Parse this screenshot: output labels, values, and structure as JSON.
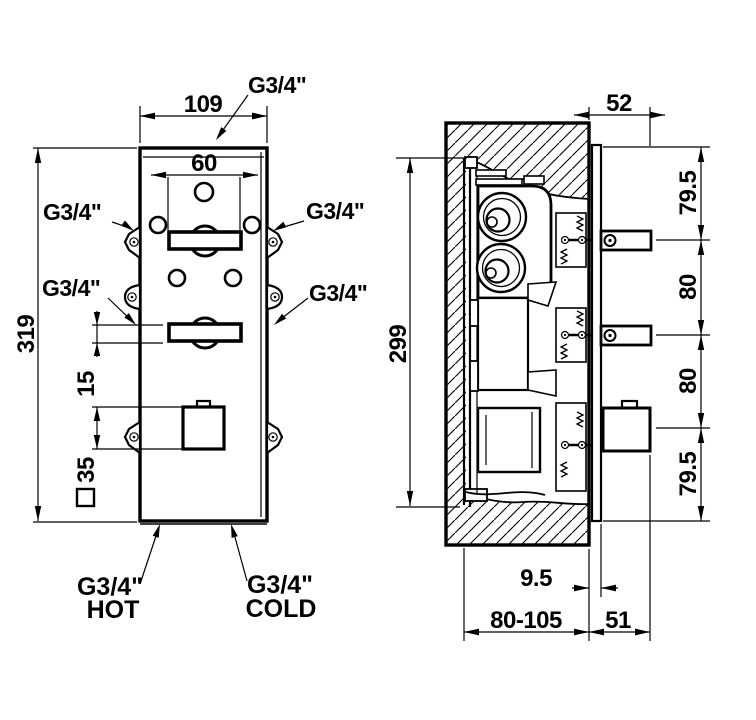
{
  "front": {
    "dims": {
      "width": "109",
      "handle_width": "60",
      "height": "319",
      "handle_to_knob": "15",
      "knob_square": "35"
    },
    "ports": {
      "top": "G3/4\"",
      "left_upper": "G3/4\"",
      "right_upper": "G3/4\"",
      "left_lower": "G3/4\"",
      "right_lower": "G3/4\"",
      "hot_size": "G3/4\"",
      "hot_word": "HOT",
      "cold_size": "G3/4\"",
      "cold_word": "COLD"
    }
  },
  "side": {
    "dims": {
      "depth": "52",
      "seg_top": "79.5",
      "seg_upper_mid": "80",
      "seg_lower_mid": "80",
      "seg_bottom": "79.5",
      "body_height": "299",
      "plate_offset": "9.5",
      "recess_depth_range": "80-105",
      "protrusion": "51"
    }
  },
  "colors": {
    "ink": "#000000",
    "paper": "#ffffff"
  }
}
